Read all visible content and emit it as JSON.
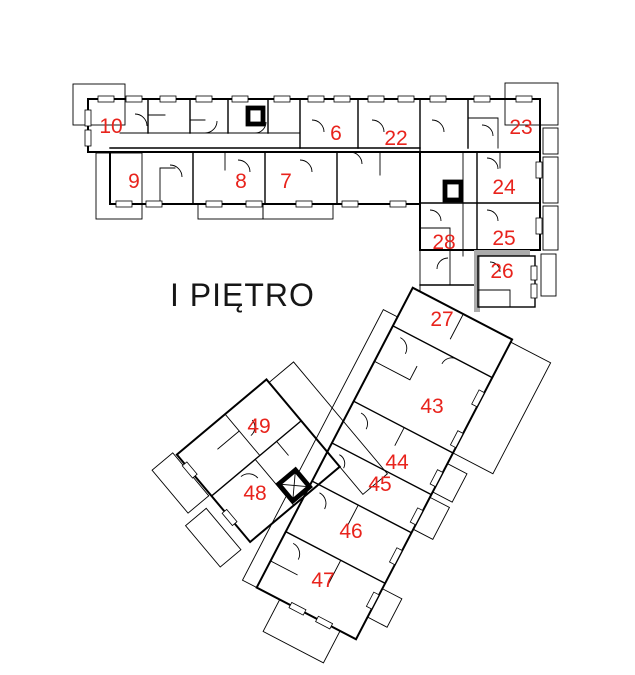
{
  "floorplan": {
    "title": "I PIĘTRO",
    "rooms": [
      {
        "number": "10"
      },
      {
        "number": "9"
      },
      {
        "number": "8"
      },
      {
        "number": "7"
      },
      {
        "number": "6"
      },
      {
        "number": "22"
      },
      {
        "number": "23"
      },
      {
        "number": "24"
      },
      {
        "number": "25"
      },
      {
        "number": "26"
      },
      {
        "number": "28"
      },
      {
        "number": "27"
      },
      {
        "number": "43"
      },
      {
        "number": "44"
      },
      {
        "number": "45"
      },
      {
        "number": "46"
      },
      {
        "number": "47"
      },
      {
        "number": "48"
      },
      {
        "number": "49"
      }
    ],
    "colors": {
      "room_number": "#e8231c",
      "walls": "#000000",
      "secondary_walls": "#ababab",
      "background": "#ffffff"
    }
  }
}
